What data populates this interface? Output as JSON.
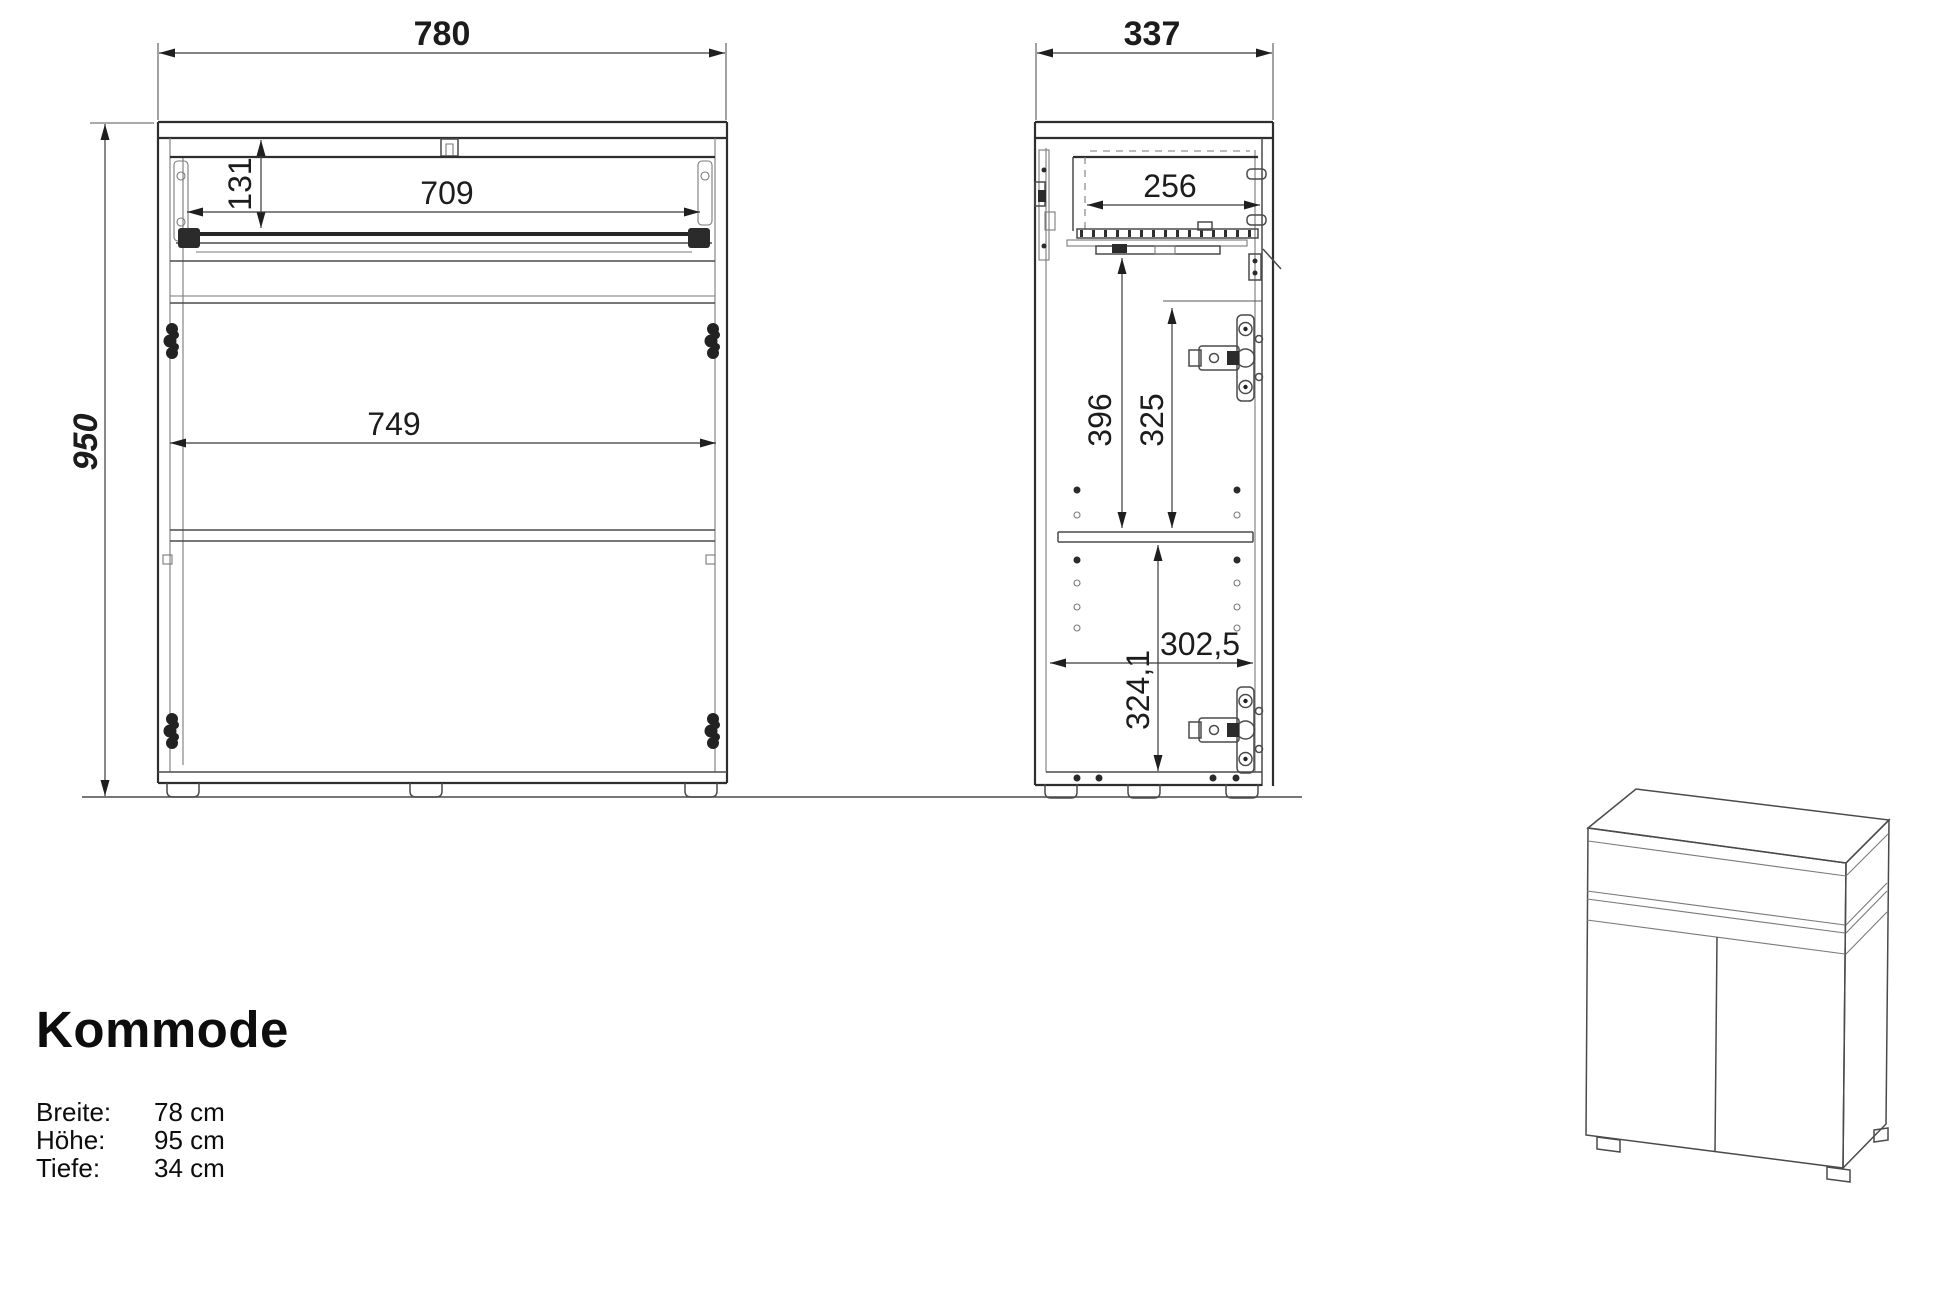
{
  "sheet": {
    "background": "#ffffff",
    "line_color": "#3a3a3a",
    "text_color": "#1c1c1c"
  },
  "product": {
    "title": "Kommode",
    "specs": [
      {
        "label": "Breite:",
        "value": "78 cm"
      },
      {
        "label": "Höhe:",
        "value": "95 cm"
      },
      {
        "label": "Tiefe:",
        "value": "34 cm"
      }
    ]
  },
  "front_view": {
    "label": "front-elevation",
    "dimensions": {
      "overall_width": "780",
      "overall_height": "950",
      "drawer_opening_height": "131",
      "drawer_width": "709",
      "inner_width": "749"
    }
  },
  "side_view": {
    "label": "side-section",
    "dimensions": {
      "overall_depth": "337",
      "drawer_depth": "256",
      "upper_compartment_height": "396",
      "door_top_to_shelf": "325",
      "inner_depth": "302,5",
      "lower_compartment_height": "324,1"
    }
  }
}
